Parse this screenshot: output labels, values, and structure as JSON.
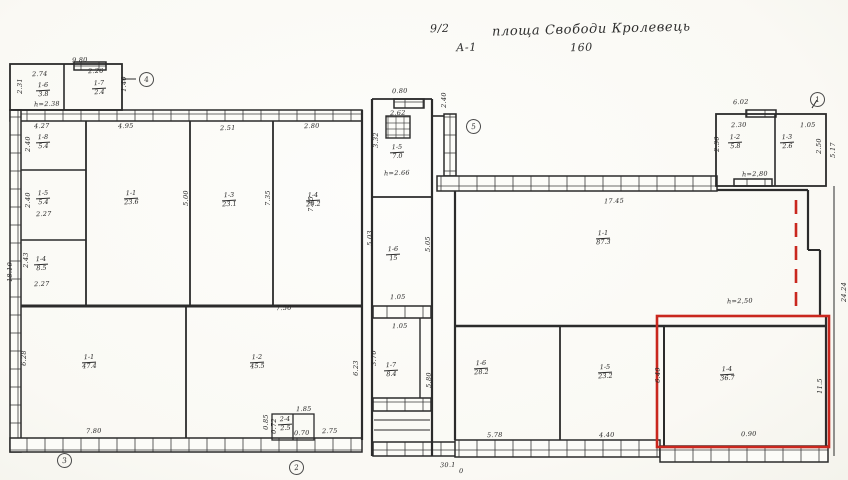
{
  "colors": {
    "ink": "#2b2b2b",
    "paper": "#faf9f4",
    "highlight_red": "#c9271e"
  },
  "header": {
    "sheet_no": "9/2",
    "title": "площа Свободи Кролевець",
    "drawing_no": "А-1",
    "scale": "160"
  },
  "markers": [
    {
      "n": "4"
    },
    {
      "n": "5"
    },
    {
      "n": "1"
    },
    {
      "n": "3"
    },
    {
      "n": "2"
    }
  ],
  "rooms": [
    {
      "num": "1-6",
      "area": "3.8"
    },
    {
      "num": "1-7",
      "area": "2.4"
    },
    {
      "num": "1-8",
      "area": "5.4"
    },
    {
      "num": "1-5",
      "area": "5.4"
    },
    {
      "num": "1-4",
      "area": "8.5"
    },
    {
      "num": "1-1",
      "area": "23.6"
    },
    {
      "num": "1-3",
      "area": "23.1"
    },
    {
      "num": "1-4",
      "area": "20.2"
    },
    {
      "num": "1-1",
      "area": "47.4"
    },
    {
      "num": "1-2",
      "area": "45.5"
    },
    {
      "num": "2-4",
      "area": "2.5"
    },
    {
      "num": "1-5",
      "area": "7.0"
    },
    {
      "num": "1-6",
      "area": "15"
    },
    {
      "num": "1-7",
      "area": "8.4"
    },
    {
      "num": "1-1",
      "area": "87.3"
    },
    {
      "num": "1-2",
      "area": "5.8"
    },
    {
      "num": "1-3",
      "area": "2.6"
    },
    {
      "num": "1-6",
      "area": "28.2"
    },
    {
      "num": "1-5",
      "area": "23.2"
    },
    {
      "num": "1-4",
      "area": "36.7"
    }
  ],
  "dims": [
    {
      "t": "9.80"
    },
    {
      "t": "2.74"
    },
    {
      "t": "2.26"
    },
    {
      "t": "2.31"
    },
    {
      "t": "1.40"
    },
    {
      "t": "h=2.38"
    },
    {
      "t": "4.27"
    },
    {
      "t": "4.95"
    },
    {
      "t": "2.51"
    },
    {
      "t": "2.80"
    },
    {
      "t": "0.80"
    },
    {
      "t": "2.40"
    },
    {
      "t": "2.62"
    },
    {
      "t": "3.32"
    },
    {
      "t": "2.40"
    },
    {
      "t": "2.40"
    },
    {
      "t": "2.27"
    },
    {
      "t": "2.43"
    },
    {
      "t": "2.27"
    },
    {
      "t": "18.10"
    },
    {
      "t": "5.00"
    },
    {
      "t": "7.35"
    },
    {
      "t": "7.35"
    },
    {
      "t": "5.03"
    },
    {
      "t": "5.05"
    },
    {
      "t": "1.05"
    },
    {
      "t": "1.05"
    },
    {
      "t": "3.70"
    },
    {
      "t": "5.80"
    },
    {
      "t": "6.28"
    },
    {
      "t": "7.80"
    },
    {
      "t": "7.56"
    },
    {
      "t": "6.23"
    },
    {
      "t": "1.85"
    },
    {
      "t": "0.85"
    },
    {
      "t": "0.72"
    },
    {
      "t": "0.70"
    },
    {
      "t": "2.75"
    },
    {
      "t": "30.1"
    },
    {
      "t": "0"
    },
    {
      "t": "17.45"
    },
    {
      "t": "6.02"
    },
    {
      "t": "2.30"
    },
    {
      "t": "1.05"
    },
    {
      "t": "2.30"
    },
    {
      "t": "2.50"
    },
    {
      "t": "5.17"
    },
    {
      "t": "h=2,80"
    },
    {
      "t": "h=2,50"
    },
    {
      "t": "5.78"
    },
    {
      "t": "4.40"
    },
    {
      "t": "6.40"
    },
    {
      "t": "0.90"
    },
    {
      "t": "11.5"
    },
    {
      "t": "24.24"
    },
    {
      "t": "h=2.66"
    }
  ]
}
